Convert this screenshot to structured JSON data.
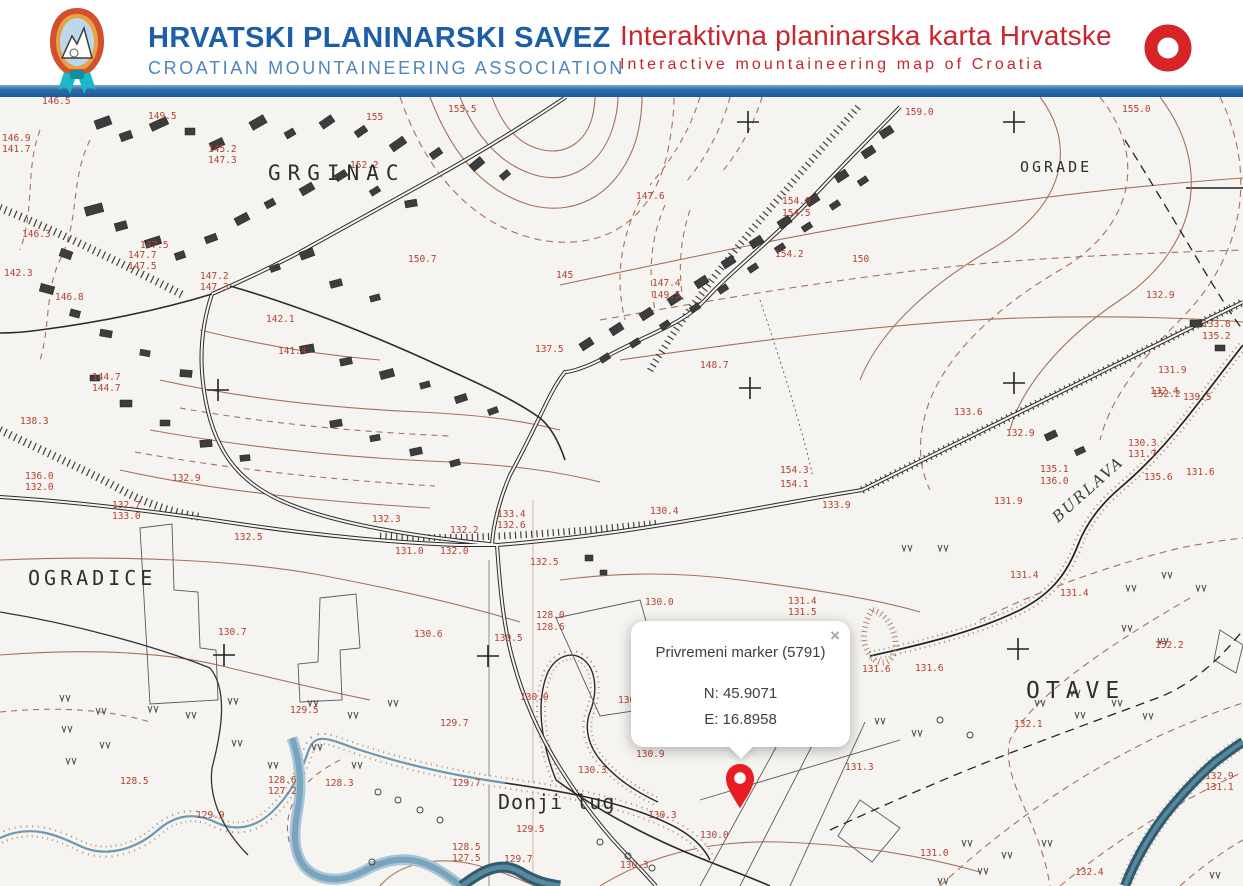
{
  "header": {
    "org_title": "HRVATSKI PLANINARSKI SAVEZ",
    "org_subtitle": "CROATIAN MOUNTAINEERING ASSOCIATION",
    "app_title": "Interaktivna planinarska karta Hrvatske",
    "app_subtitle": "Interactive mountaineering map of Croatia",
    "colors": {
      "org_blue": "#1d5fa7",
      "subtitle_blue": "#4e86bd",
      "app_red": "#c9252c",
      "bar_blue": "#185a9b"
    }
  },
  "popup": {
    "title": "Privremeni marker (5791)",
    "lat": "N: 45.9071",
    "lon": "E: 16.8958",
    "close_label": "×"
  },
  "marker": {
    "color": "#e81c24"
  },
  "map": {
    "place_labels": [
      {
        "text": "GRGINAC",
        "x": 268,
        "y": 180,
        "size": 21,
        "ls": 7
      },
      {
        "text": "OGRADE",
        "x": 1020,
        "y": 172,
        "size": 15,
        "ls": 3
      },
      {
        "text": "OGRADICE",
        "x": 28,
        "y": 585,
        "size": 20,
        "ls": 4
      },
      {
        "text": "OTAVE",
        "x": 1026,
        "y": 698,
        "size": 23,
        "ls": 6
      },
      {
        "text": "Donji lug",
        "x": 498,
        "y": 809,
        "size": 20,
        "ls": 1
      },
      {
        "text": "BURLAVA",
        "x": 1058,
        "y": 523,
        "size": 15,
        "ls": 2,
        "rot": -42,
        "italic": true
      }
    ],
    "elevation_labels": [
      {
        "t": "146.5",
        "x": 42,
        "y": 104
      },
      {
        "t": "149.5",
        "x": 148,
        "y": 119
      },
      {
        "t": "145.2",
        "x": 208,
        "y": 152
      },
      {
        "t": "147.3",
        "x": 208,
        "y": 163
      },
      {
        "t": "146.9",
        "x": 2,
        "y": 141
      },
      {
        "t": "141.7",
        "x": 2,
        "y": 152
      },
      {
        "t": "146.3",
        "x": 22,
        "y": 237
      },
      {
        "t": "142.3",
        "x": 4,
        "y": 276
      },
      {
        "t": "146.8",
        "x": 55,
        "y": 300
      },
      {
        "t": "147.5",
        "x": 140,
        "y": 248
      },
      {
        "t": "147.7",
        "x": 128,
        "y": 258
      },
      {
        "t": "147.5",
        "x": 128,
        "y": 269
      },
      {
        "t": "147.2",
        "x": 200,
        "y": 279
      },
      {
        "t": "147.3",
        "x": 200,
        "y": 290
      },
      {
        "t": "144.7",
        "x": 92,
        "y": 380
      },
      {
        "t": "144.7",
        "x": 92,
        "y": 391
      },
      {
        "t": "142.1",
        "x": 266,
        "y": 322
      },
      {
        "t": "141.4",
        "x": 278,
        "y": 354
      },
      {
        "t": "152.2",
        "x": 350,
        "y": 168
      },
      {
        "t": "150.7",
        "x": 408,
        "y": 262
      },
      {
        "t": "155",
        "x": 366,
        "y": 120
      },
      {
        "t": "155.5",
        "x": 448,
        "y": 112
      },
      {
        "t": "155.0",
        "x": 1122,
        "y": 112
      },
      {
        "t": "159.0",
        "x": 905,
        "y": 115
      },
      {
        "t": "147.6",
        "x": 636,
        "y": 199
      },
      {
        "t": "145",
        "x": 556,
        "y": 278
      },
      {
        "t": "154.0",
        "x": 782,
        "y": 204
      },
      {
        "t": "154.5",
        "x": 782,
        "y": 216
      },
      {
        "t": "154.2",
        "x": 775,
        "y": 257
      },
      {
        "t": "150",
        "x": 852,
        "y": 262
      },
      {
        "t": "147.4",
        "x": 652,
        "y": 286
      },
      {
        "t": "149.5",
        "x": 652,
        "y": 298
      },
      {
        "t": "148.7",
        "x": 700,
        "y": 368
      },
      {
        "t": "137.5",
        "x": 535,
        "y": 352
      },
      {
        "t": "139.5",
        "x": 1183,
        "y": 400
      },
      {
        "t": "135.1",
        "x": 1040,
        "y": 472
      },
      {
        "t": "136.0",
        "x": 1040,
        "y": 484
      },
      {
        "t": "135.6",
        "x": 1144,
        "y": 480
      },
      {
        "t": "132.9",
        "x": 1146,
        "y": 298
      },
      {
        "t": "133.8",
        "x": 1202,
        "y": 327
      },
      {
        "t": "135.2",
        "x": 1202,
        "y": 339
      },
      {
        "t": "132.4",
        "x": 1150,
        "y": 394
      },
      {
        "t": "154.3",
        "x": 780,
        "y": 473
      },
      {
        "t": "154.1",
        "x": 780,
        "y": 487
      },
      {
        "t": "133.4",
        "x": 497,
        "y": 517
      },
      {
        "t": "132.6",
        "x": 497,
        "y": 528
      },
      {
        "t": "132.2",
        "x": 450,
        "y": 533
      },
      {
        "t": "132.5",
        "x": 530,
        "y": 565
      },
      {
        "t": "131.0",
        "x": 395,
        "y": 554
      },
      {
        "t": "132.0",
        "x": 440,
        "y": 554
      },
      {
        "t": "128.0",
        "x": 536,
        "y": 618
      },
      {
        "t": "128.6",
        "x": 536,
        "y": 630
      },
      {
        "t": "130.5",
        "x": 494,
        "y": 641
      },
      {
        "t": "130.6",
        "x": 414,
        "y": 637
      },
      {
        "t": "130.0",
        "x": 645,
        "y": 605
      },
      {
        "t": "130.4",
        "x": 650,
        "y": 514
      },
      {
        "t": "132.7",
        "x": 112,
        "y": 508
      },
      {
        "t": "133.0",
        "x": 112,
        "y": 519
      },
      {
        "t": "136.0",
        "x": 25,
        "y": 479
      },
      {
        "t": "132.0",
        "x": 25,
        "y": 490
      },
      {
        "t": "138.3",
        "x": 20,
        "y": 424
      },
      {
        "t": "132.9",
        "x": 172,
        "y": 481
      },
      {
        "t": "132.5",
        "x": 234,
        "y": 540
      },
      {
        "t": "132.3",
        "x": 372,
        "y": 522
      },
      {
        "t": "130.7",
        "x": 218,
        "y": 635
      },
      {
        "t": "129.5",
        "x": 290,
        "y": 713
      },
      {
        "t": "128.6",
        "x": 268,
        "y": 783
      },
      {
        "t": "127.2",
        "x": 268,
        "y": 794
      },
      {
        "t": "128.3",
        "x": 325,
        "y": 786
      },
      {
        "t": "129.7",
        "x": 452,
        "y": 786
      },
      {
        "t": "128.5",
        "x": 120,
        "y": 784
      },
      {
        "t": "128.5",
        "x": 452,
        "y": 850
      },
      {
        "t": "127.5",
        "x": 452,
        "y": 861
      },
      {
        "t": "129.5",
        "x": 516,
        "y": 832
      },
      {
        "t": "129.7",
        "x": 504,
        "y": 862
      },
      {
        "t": "129.7",
        "x": 440,
        "y": 726
      },
      {
        "t": "130.0",
        "x": 520,
        "y": 700
      },
      {
        "t": "130.9",
        "x": 618,
        "y": 703
      },
      {
        "t": "130.9",
        "x": 636,
        "y": 757
      },
      {
        "t": "130.3",
        "x": 578,
        "y": 773
      },
      {
        "t": "130.3",
        "x": 648,
        "y": 818
      },
      {
        "t": "130.3",
        "x": 620,
        "y": 868
      },
      {
        "t": "130.0",
        "x": 700,
        "y": 838
      },
      {
        "t": "133.6",
        "x": 954,
        "y": 415
      },
      {
        "t": "132.9",
        "x": 1006,
        "y": 436
      },
      {
        "t": "152.2",
        "x": 1152,
        "y": 397
      },
      {
        "t": "130.3",
        "x": 1128,
        "y": 446
      },
      {
        "t": "131.7",
        "x": 1128,
        "y": 457
      },
      {
        "t": "131.6",
        "x": 1186,
        "y": 475
      },
      {
        "t": "131.9",
        "x": 994,
        "y": 504
      },
      {
        "t": "131.4",
        "x": 1010,
        "y": 578
      },
      {
        "t": "131.4",
        "x": 1060,
        "y": 596
      },
      {
        "t": "131.9",
        "x": 1158,
        "y": 373
      },
      {
        "t": "131.4",
        "x": 788,
        "y": 604
      },
      {
        "t": "131.5",
        "x": 788,
        "y": 615
      },
      {
        "t": "131.5",
        "x": 814,
        "y": 653
      },
      {
        "t": "131.6",
        "x": 862,
        "y": 672
      },
      {
        "t": "131.6",
        "x": 915,
        "y": 671
      },
      {
        "t": "133.9",
        "x": 822,
        "y": 508
      },
      {
        "t": "131.3",
        "x": 845,
        "y": 770
      },
      {
        "t": "131.0",
        "x": 920,
        "y": 856
      },
      {
        "t": "132.9",
        "x": 1205,
        "y": 779
      },
      {
        "t": "131.1",
        "x": 1205,
        "y": 790
      },
      {
        "t": "132.4",
        "x": 1075,
        "y": 875
      },
      {
        "t": "132.1",
        "x": 1014,
        "y": 727
      },
      {
        "t": "152.2",
        "x": 1155,
        "y": 648
      },
      {
        "t": "129.9",
        "x": 196,
        "y": 818
      }
    ]
  }
}
